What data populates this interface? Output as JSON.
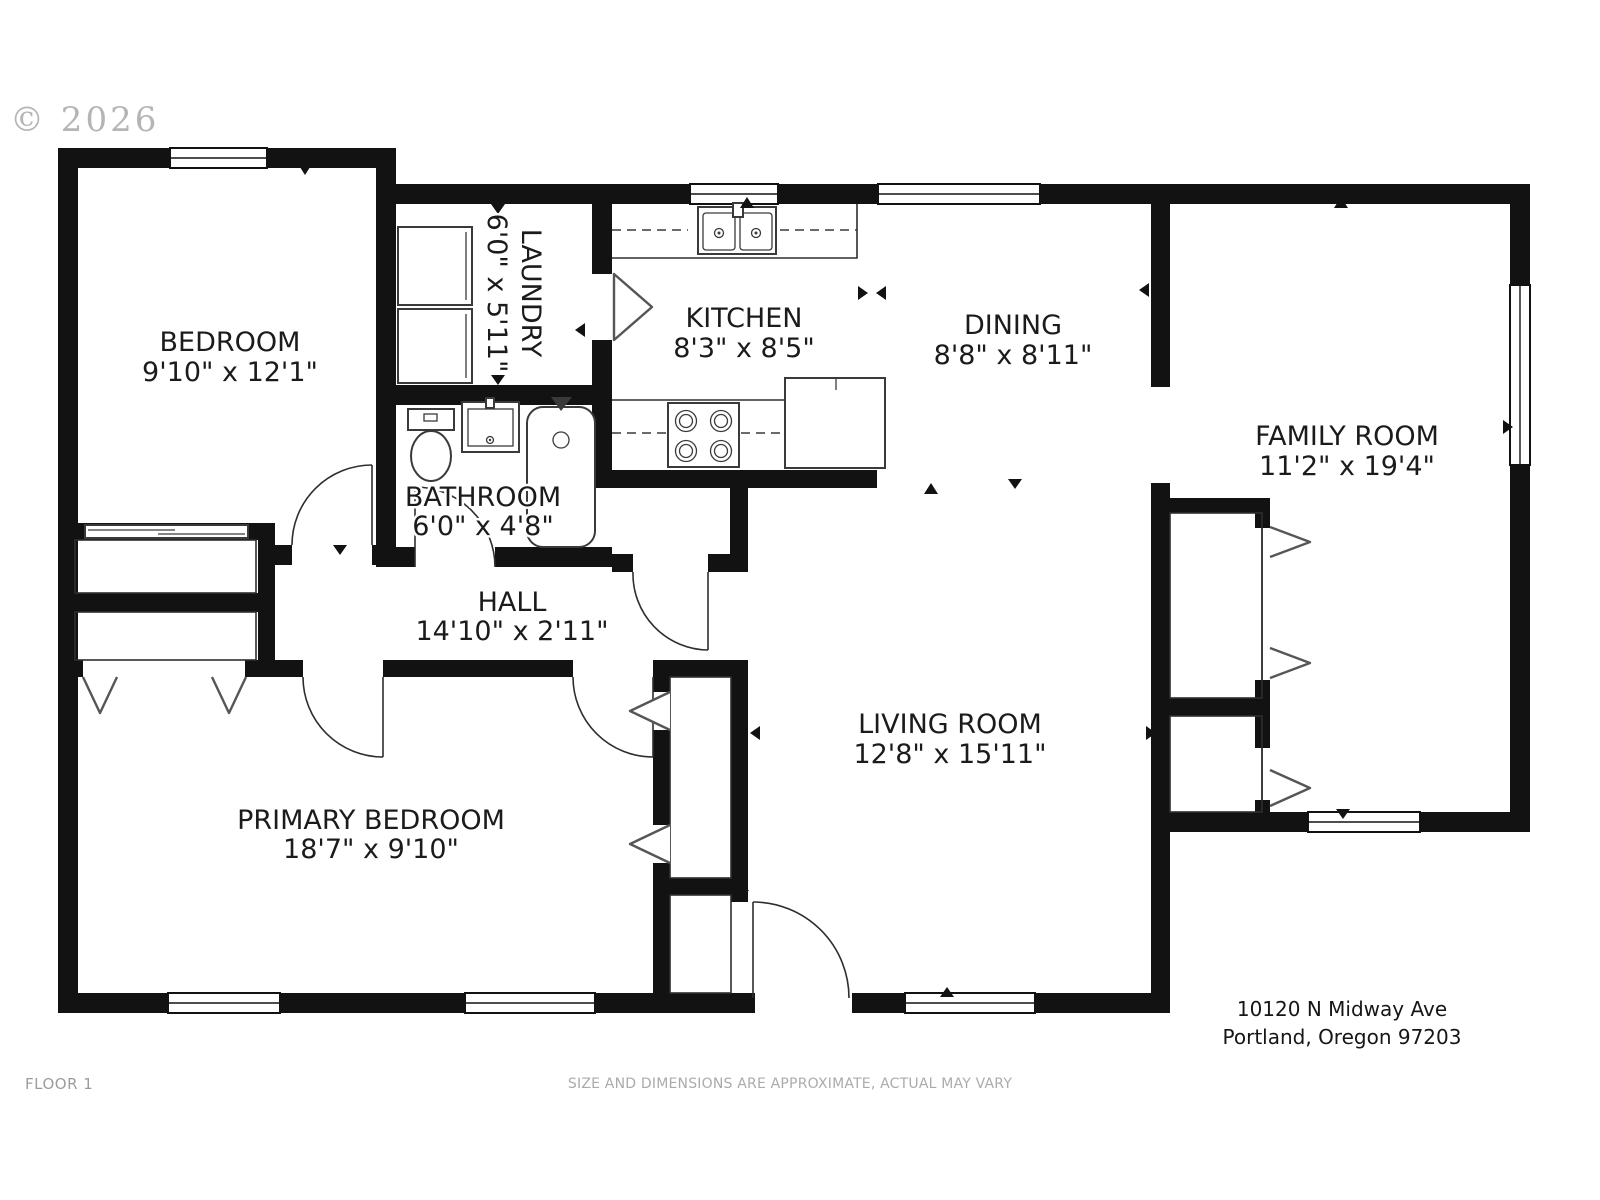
{
  "copyright": "© 2026",
  "floor_label": "FLOOR 1",
  "disclaimer": "SIZE AND DIMENSIONS ARE APPROXIMATE, ACTUAL MAY VARY",
  "address": {
    "line1": "10120 N Midway Ave",
    "line2": "Portland, Oregon 97203"
  },
  "colors": {
    "walls": "#121212",
    "fixtures": "#3a3a3a",
    "labels": "#1b1b1b",
    "muted_text": "#9c9c9c"
  },
  "rooms": [
    {
      "name": "BEDROOM",
      "dimensions": "9'10\" x 12'1\""
    },
    {
      "name": "LAUNDRY",
      "dimensions": "6'0\" x 5'11\""
    },
    {
      "name": "KITCHEN",
      "dimensions": "8'3\" x 8'5\""
    },
    {
      "name": "DINING",
      "dimensions": "8'8\" x 8'11\""
    },
    {
      "name": "FAMILY ROOM",
      "dimensions": "11'2\" x 19'4\""
    },
    {
      "name": "BATHROOM",
      "dimensions": "6'0\" x 4'8\""
    },
    {
      "name": "HALL",
      "dimensions": "14'10\" x 2'11\""
    },
    {
      "name": "PRIMARY BEDROOM",
      "dimensions": "18'7\" x 9'10\""
    },
    {
      "name": "LIVING ROOM",
      "dimensions": "12'8\" x 15'11\""
    }
  ]
}
